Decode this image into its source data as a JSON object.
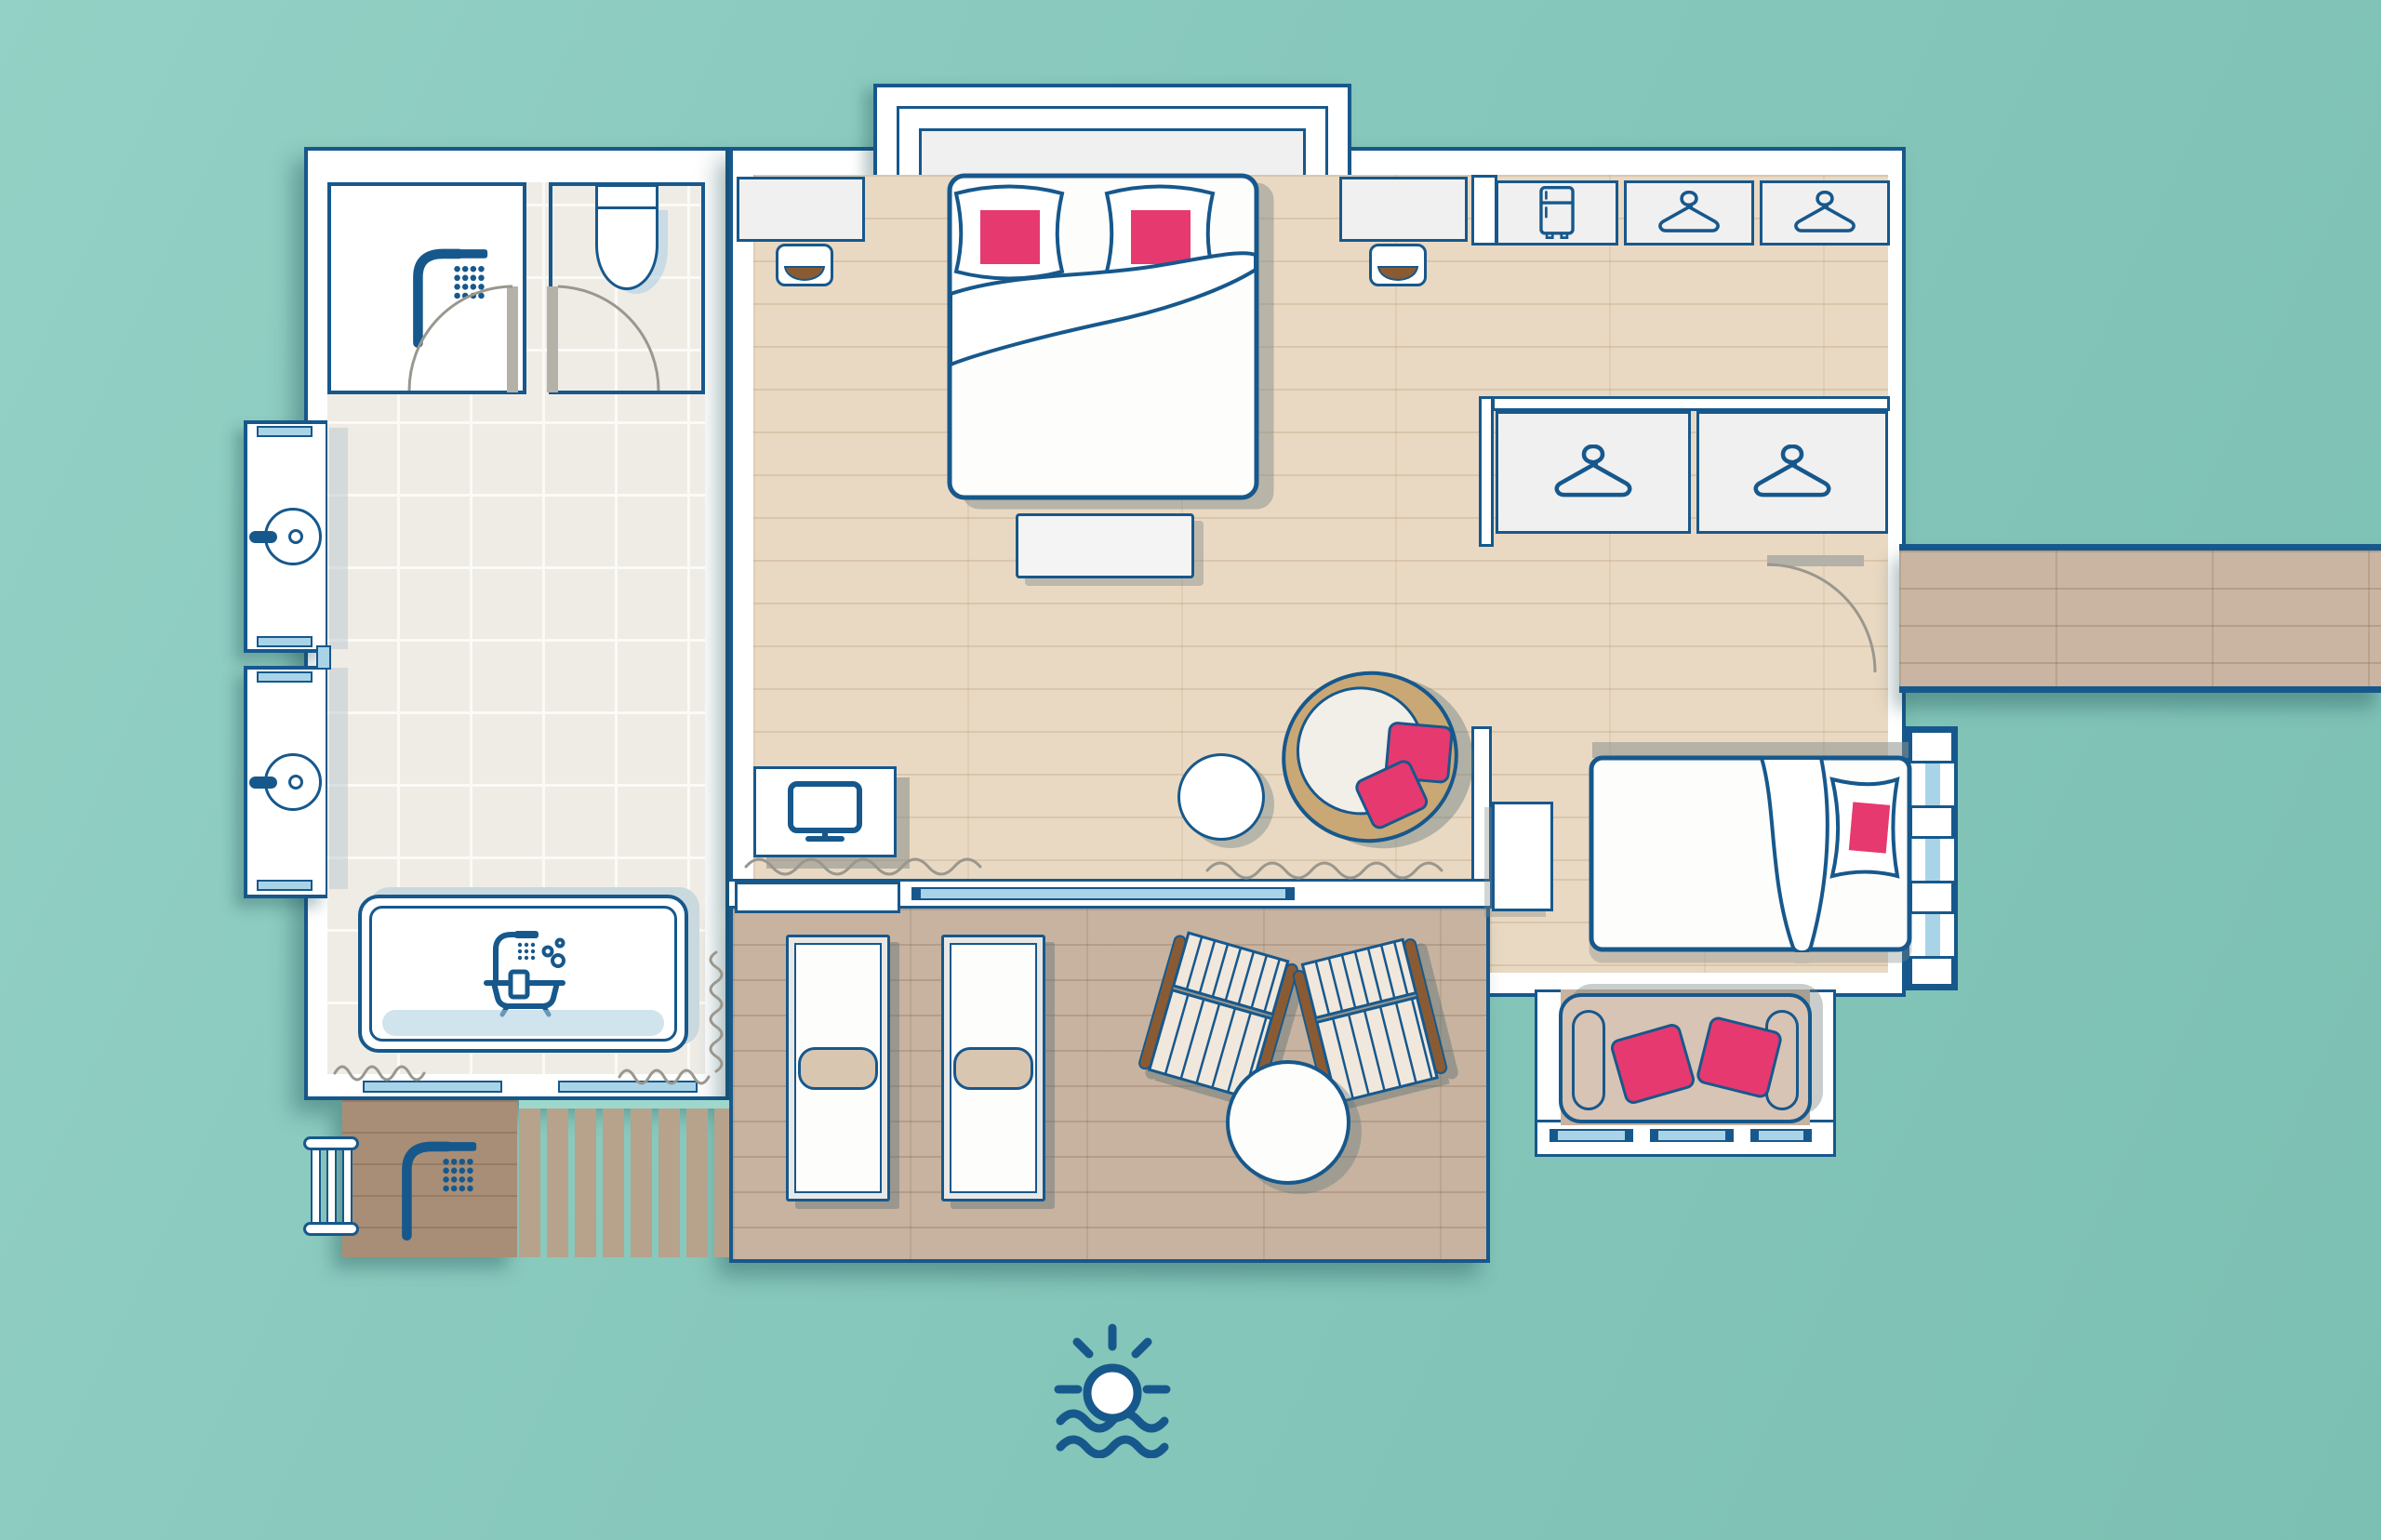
{
  "title": "Overwater villa floor plan",
  "scene": {
    "type": "floor-plan",
    "view": "top-down",
    "setting": "bungalow over water with sun deck and entry jetty"
  },
  "colors": {
    "navy": "#17588c",
    "pink": "#e6396f",
    "water": "#87c8bc",
    "tile": "#efece6",
    "wood": "#e9d9c3",
    "deck": "#c7b3a0",
    "jetty": "#c9b5a2",
    "platform": "#a88e76",
    "glass": "#a9d4e8",
    "gray": "#f0f0f0",
    "tan": "#d8c4b4",
    "brown": "#8a5b33",
    "arc": "#9a978e",
    "leaf": "#b4b1a8"
  },
  "icons": [
    {
      "name": "shower-icon",
      "meaning": "walk-in rain shower"
    },
    {
      "name": "toilet-icon",
      "meaning": "WC"
    },
    {
      "name": "washbasin-icon",
      "meaning": "vanity sink",
      "count": 2
    },
    {
      "name": "bathtub-icon",
      "meaning": "bathtub with shower and bubbles"
    },
    {
      "name": "fridge-icon",
      "meaning": "minibar fridge cabinet"
    },
    {
      "name": "hanger-icon",
      "meaning": "wardrobe module",
      "count": 4
    },
    {
      "name": "tv-icon",
      "meaning": "television console"
    },
    {
      "name": "outdoor-shower-icon",
      "meaning": "outdoor shower"
    },
    {
      "name": "sun-over-water-icon",
      "meaning": "sun setting over the sea"
    }
  ],
  "rooms": [
    "shower-room",
    "wc",
    "bathroom-with-double-vanity",
    "main-bedroom",
    "dressing-area",
    "living-area",
    "second-bedroom",
    "lounge-window-bay",
    "sun-deck",
    "outdoor-shower-platform",
    "entry-jetty"
  ],
  "furniture": [
    {
      "item": "king-bed",
      "pillows": 2,
      "pillow_color": "pink"
    },
    {
      "item": "foot-bench",
      "count": 1
    },
    {
      "item": "bedside-desk-with-stool",
      "count": 2
    },
    {
      "item": "minibar-cabinet",
      "count": 1
    },
    {
      "item": "wardrobe-module",
      "count": 4
    },
    {
      "item": "tv-console",
      "count": 1
    },
    {
      "item": "round-side-table",
      "count": 1
    },
    {
      "item": "papasan-chair",
      "pillows": 2,
      "pillow_color": "pink"
    },
    {
      "item": "single-bed",
      "pillows": 1,
      "pillow_color": "pink"
    },
    {
      "item": "nightstand",
      "count": 1
    },
    {
      "item": "sofa",
      "pillows": 2,
      "pillow_color": "pink"
    },
    {
      "item": "sun-lounger",
      "count": 2
    },
    {
      "item": "folding-deck-chair",
      "count": 2
    },
    {
      "item": "round-deck-table",
      "count": 1
    },
    {
      "item": "bathtub",
      "count": 1
    },
    {
      "item": "washbasin",
      "count": 2
    },
    {
      "item": "toilet",
      "count": 1
    },
    {
      "item": "sea-ladder",
      "count": 1
    },
    {
      "item": "sliding-glass-door",
      "count": 1
    }
  ]
}
